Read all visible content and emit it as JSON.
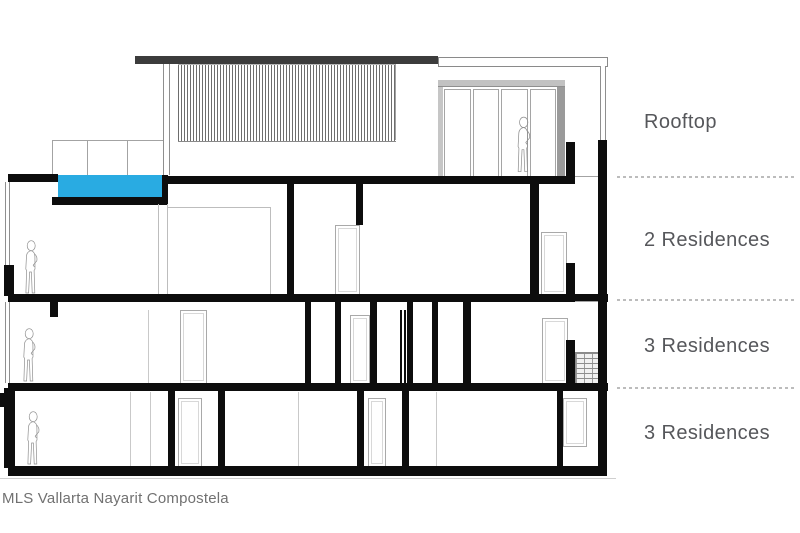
{
  "diagram": {
    "type": "building-cross-section",
    "levels": [
      {
        "label": "Rooftop"
      },
      {
        "label": "2 Residences"
      },
      {
        "label": "3 Residences"
      },
      {
        "label": "3 Residences"
      }
    ],
    "caption": "MLS Vallarta Nayarit Compostela",
    "colors": {
      "pool_water": "#29abe2",
      "roof_slab_dark": "#3c3c3c",
      "structure_black": "#0d0d0d",
      "label_text": "#56575b",
      "caption_text": "#717171",
      "separator_dashed": "#bcbcbc"
    }
  }
}
